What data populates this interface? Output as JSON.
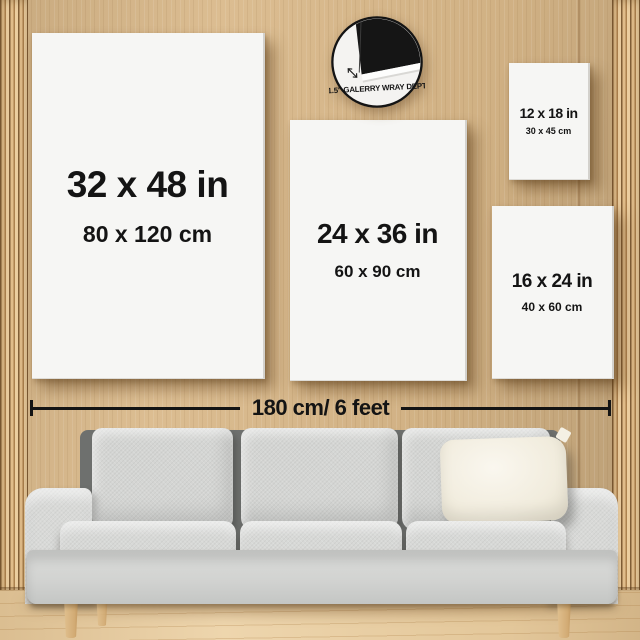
{
  "page": {
    "title": "Canvas wall-art size comparison"
  },
  "badge": {
    "label": "1.5\" GALERRY WRAY DEPT"
  },
  "canvases": [
    {
      "id": "32x48",
      "inches": "32 x 48 in",
      "cm": "80 x 120 cm"
    },
    {
      "id": "24x36",
      "inches": "24 x 36 in",
      "cm": "60 x 90 cm"
    },
    {
      "id": "12x18",
      "inches": "12 x 18 in",
      "cm": "30 x 45 cm"
    },
    {
      "id": "16x24",
      "inches": "16 x 24 in",
      "cm": "40 x 60 cm"
    }
  ],
  "measurement": {
    "label": "180 cm/ 6 feet"
  },
  "colors": {
    "wall_wood": "#d9b889",
    "trim_wood": "#c79e6b",
    "floor_wood": "#ecd1a4",
    "canvas_white": "#f6f6f4",
    "text_black": "#141414",
    "sofa_gray": "#d6d7d5",
    "pillow_cream": "#f4f0e4",
    "badge_black": "#151515"
  }
}
